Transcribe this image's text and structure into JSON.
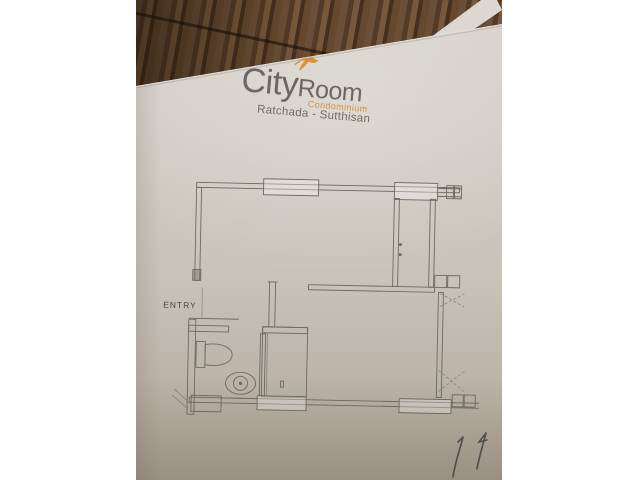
{
  "photo": {
    "logo": {
      "brand_city": "City",
      "brand_room": "Room",
      "brand_tagline": "Condominium",
      "brand_location": "Ratchada - Sutthisan"
    },
    "floor_plan": {
      "entry_label": "ENTRY"
    },
    "colors": {
      "brand_orange": "#DD8F3F",
      "brand_gray": "#6E6761",
      "paper": "#CCC7BF",
      "plan_line": "#6F6960",
      "wood_brown": "#5C452F"
    }
  }
}
